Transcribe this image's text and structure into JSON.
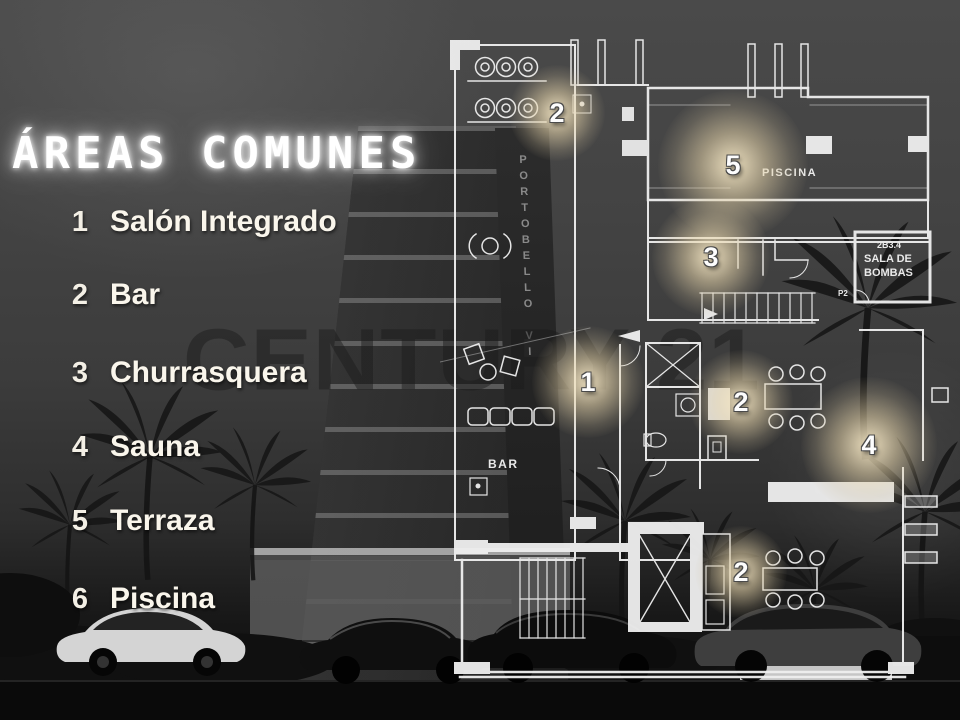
{
  "title": "ÁREAS COMUNES",
  "watermark": "CENTURY 21",
  "building_sign": "PORTOBELLO VI",
  "legend": {
    "items": [
      {
        "number": "1",
        "label": "Salón Integrado"
      },
      {
        "number": "2",
        "label": "Bar"
      },
      {
        "number": "3",
        "label": "Churrasquera"
      },
      {
        "number": "4",
        "label": "Sauna"
      },
      {
        "number": "5",
        "label": "Terraza"
      },
      {
        "number": "6",
        "label": "Piscina"
      }
    ]
  },
  "floorplan": {
    "labels": {
      "piscina": "PISCINA",
      "sala_room_number": "2B3.4",
      "sala_line1": "SALA DE",
      "sala_line2": "BOMBAS",
      "bar": "BAR",
      "p2": "P2"
    },
    "markers": [
      {
        "value": "2"
      },
      {
        "value": "5"
      },
      {
        "value": "3"
      },
      {
        "value": "1"
      },
      {
        "value": "2"
      },
      {
        "value": "4"
      },
      {
        "value": "2"
      }
    ]
  },
  "colors": {
    "background": "#3f3f3f",
    "plan_line": "#f0f0f0",
    "marker_glow": "#e8d6ac",
    "text": "#faf6ec"
  }
}
